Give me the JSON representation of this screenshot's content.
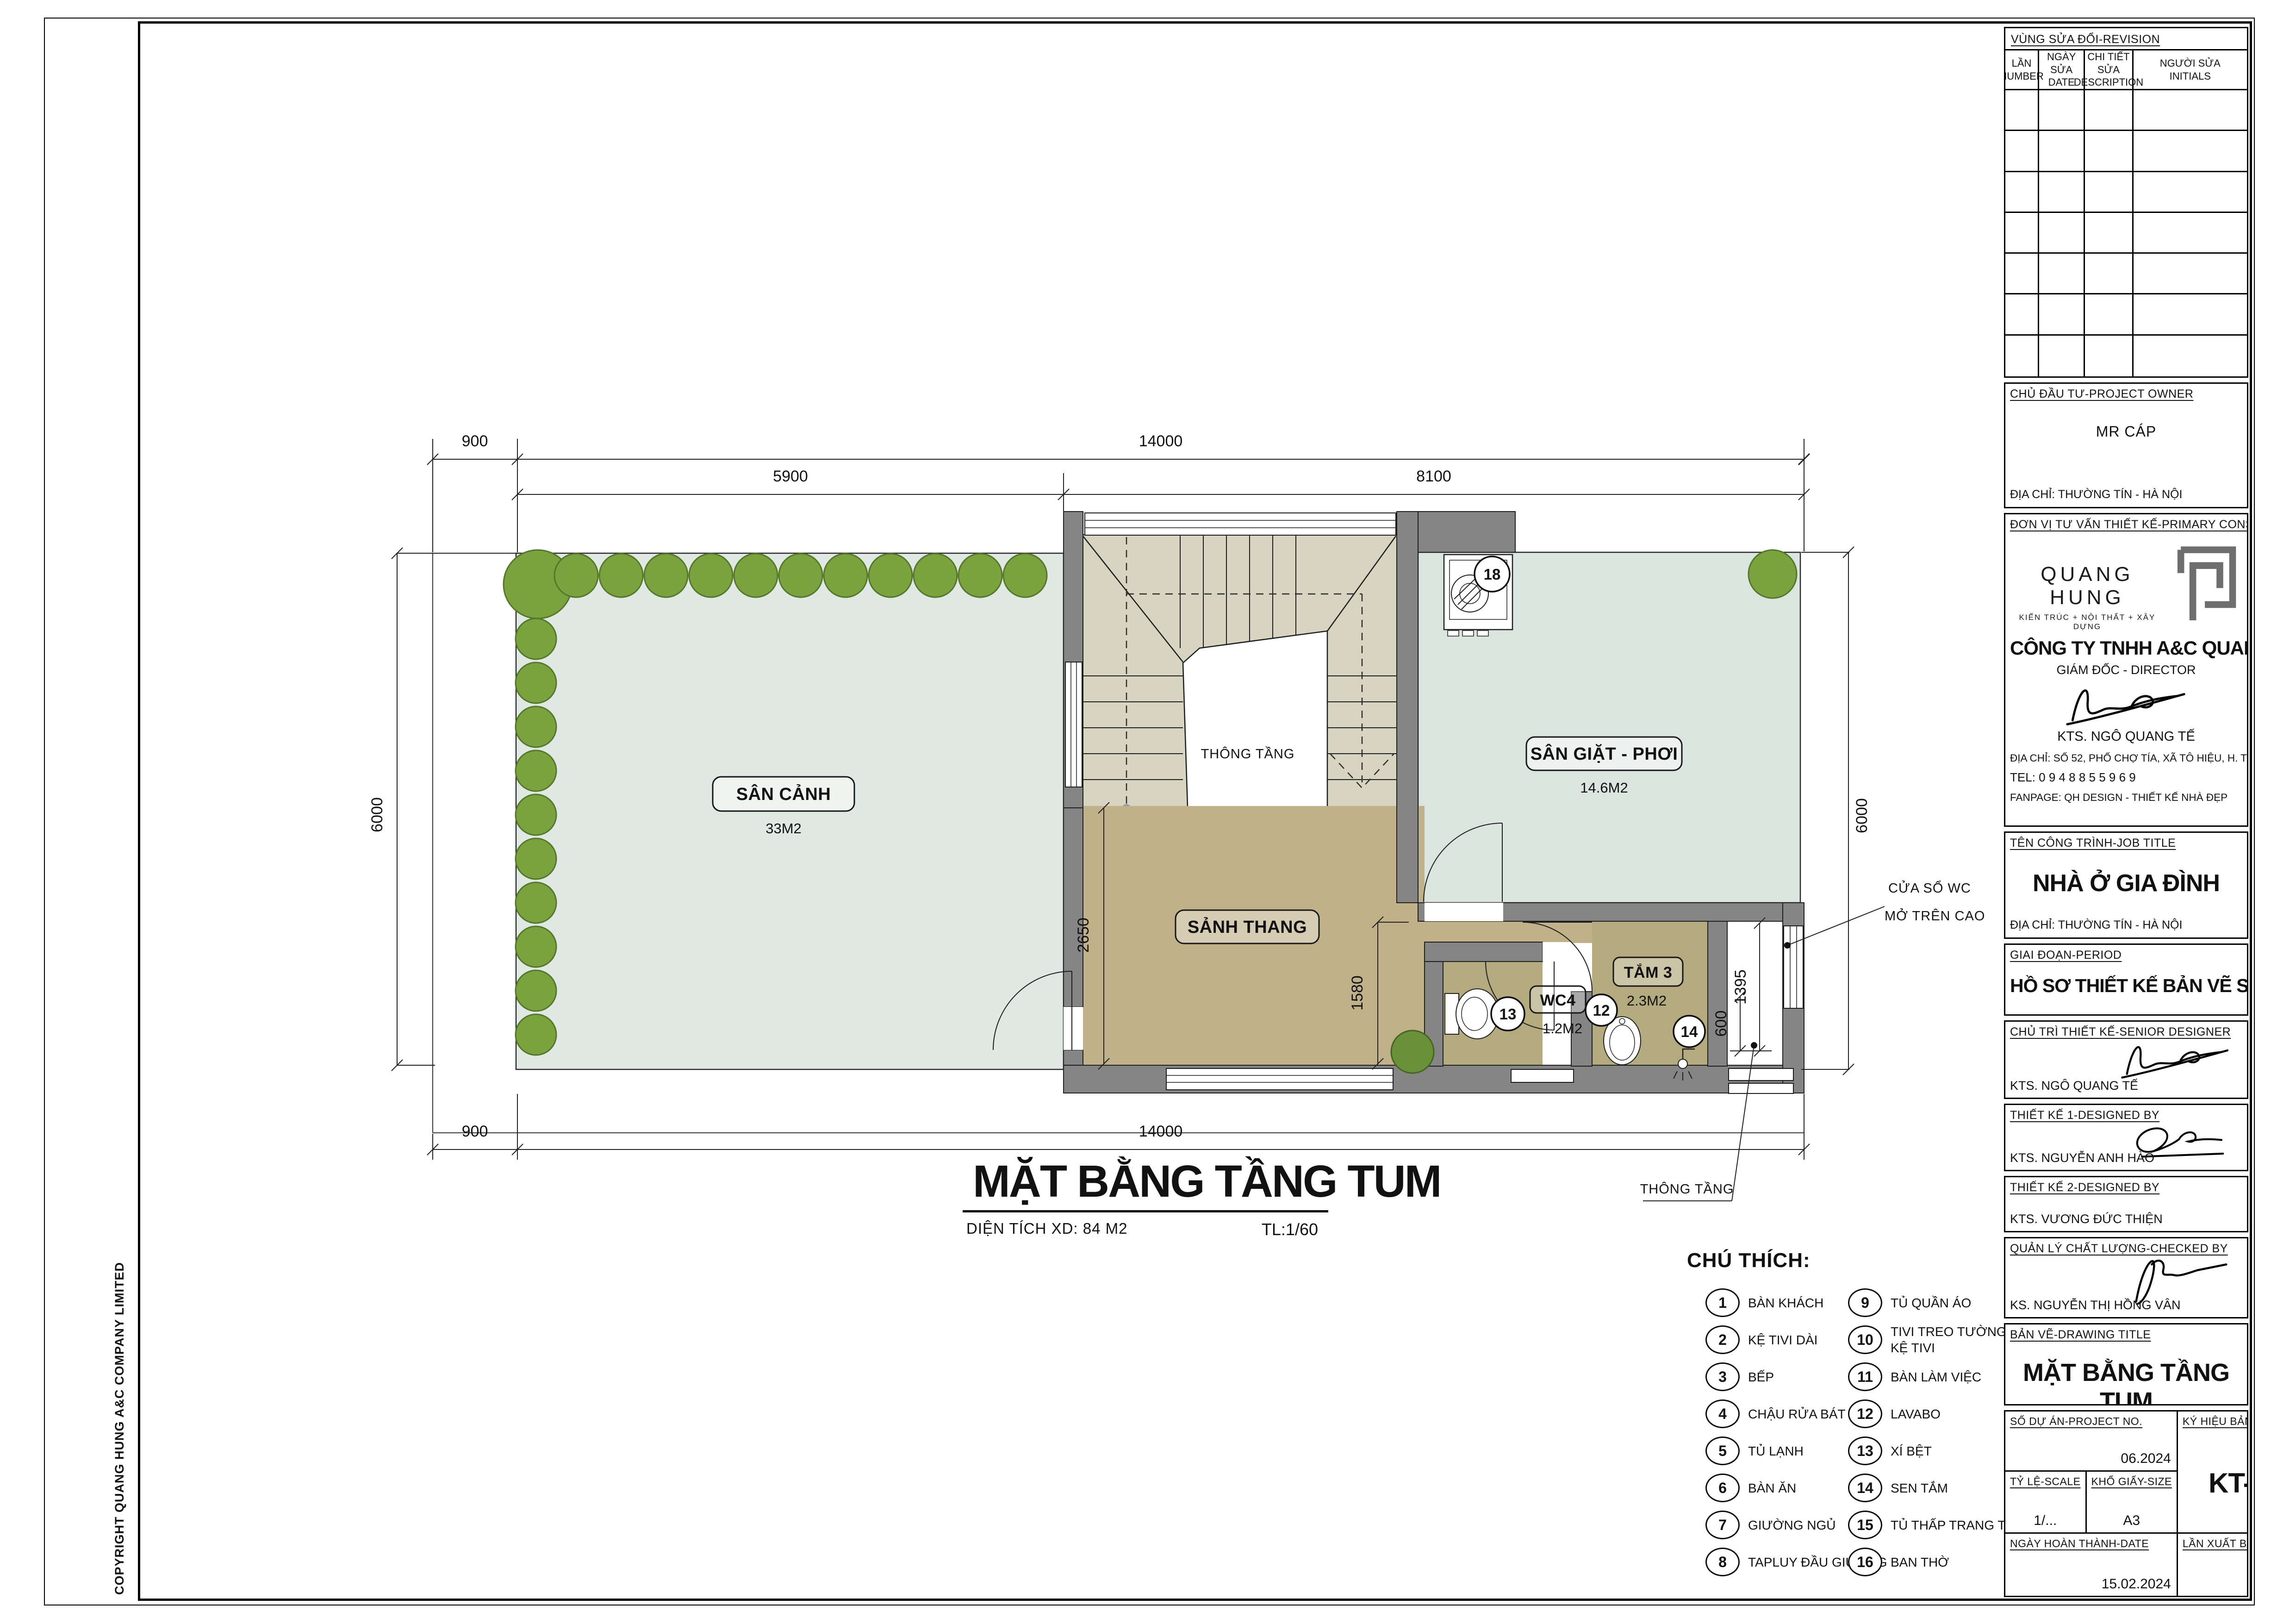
{
  "sheet": {
    "copyright": "COPYRIGHT QUANG HUNG A&C COMPANY LIMITED"
  },
  "colors": {
    "wall": "#858585",
    "garden_floor": "#dfe8e2",
    "laundry_floor": "#dbe5e0",
    "stair_floor": "#d8d4c2",
    "hall_floor": "#c0b18b",
    "bath_floor": "#b4aa80",
    "tree": "#7aa23e",
    "line": "#1c1c1c"
  },
  "plan": {
    "caption": {
      "title": "MẶT BẰNG TẦNG TUM",
      "area": "DIỆN TÍCH XD: 84 M2",
      "scale": "TL:1/60"
    },
    "rooms": {
      "san_canh": {
        "name": "SÂN CẢNH",
        "area": "33M2"
      },
      "san_giat": {
        "name": "SÂN GIẶT - PHƠI",
        "area": "14.6M2"
      },
      "sanh_thang": {
        "name": "SẢNH THANG"
      },
      "tam3": {
        "name": "TẮM 3",
        "area": "2.3M2"
      },
      "wc4": {
        "name": "WC4",
        "area": "1.2M2"
      },
      "stair_void": "THÔNG TẦNG"
    },
    "markers": {
      "washer": "18",
      "lavabo": "12",
      "toilet": "13",
      "shower": "14"
    },
    "dims": {
      "offset": "900",
      "total": "14000",
      "left_span": "5900",
      "right_span": "8100",
      "height": "6000",
      "hall": "2650",
      "bath": "1580",
      "shaft_h": "1395",
      "shaft_w": "600"
    },
    "notes": {
      "wc_window1": "CỬA SỔ WC",
      "wc_window2": "MỞ TRÊN CAO",
      "void": "THÔNG TẦNG"
    }
  },
  "legend": {
    "title": "CHÚ THÍCH:",
    "items": [
      {
        "num": "1",
        "label": "BÀN KHÁCH"
      },
      {
        "num": "2",
        "label": "KỆ TIVI DÀI"
      },
      {
        "num": "3",
        "label": "BẾP"
      },
      {
        "num": "4",
        "label": "CHẬU RỬA BÁT"
      },
      {
        "num": "5",
        "label": "TỦ LẠNH"
      },
      {
        "num": "6",
        "label": "BÀN ĂN"
      },
      {
        "num": "7",
        "label": "GIƯỜNG NGỦ"
      },
      {
        "num": "8",
        "label": "TAPLUY ĐẦU GIƯỜNG"
      },
      {
        "num": "9",
        "label": "TỦ QUẦN ÁO"
      },
      {
        "num": "10",
        "label": "TIVI TREO TƯỜNG",
        "label2": "KỆ TIVI"
      },
      {
        "num": "11",
        "label": "BÀN LÀM VIỆC"
      },
      {
        "num": "12",
        "label": "LAVABO"
      },
      {
        "num": "13",
        "label": "XÍ BỆT"
      },
      {
        "num": "14",
        "label": "SEN TẮM"
      },
      {
        "num": "15",
        "label": "TỦ THẤP TRANG TRÍ"
      },
      {
        "num": "16",
        "label": "BAN THỜ"
      }
    ]
  },
  "titleblock": {
    "revision": {
      "title": "VÙNG SỬA ĐỔI-REVISION",
      "cols": [
        {
          "l1": "LẦN",
          "l2": "NUMBER"
        },
        {
          "l1": "NGÀY SỬA",
          "l2": "DATE"
        },
        {
          "l1": "CHI TIẾT SỬA",
          "l2": "DESCRIPTION"
        },
        {
          "l1": "NGƯỜI SỬA",
          "l2": "INITIALS"
        }
      ]
    },
    "owner": {
      "heading": "CHỦ ĐẦU TƯ-PROJECT OWNER",
      "name": "MR CÁP",
      "address": "ĐỊA CHỈ: THƯỜNG TÍN - HÀ NỘI"
    },
    "consultant": {
      "heading": "ĐƠN VỊ TƯ VẤN THIẾT KẾ-PRIMARY CONSULTANT",
      "logo_name": "QUANG HUNG",
      "logo_tagline": "KIẾN TRÚC + NỘI THẤT + XÂY DỰNG",
      "company": "CÔNG TY TNHH A&C QUANG HƯNG",
      "role": "GIÁM ĐỐC - DIRECTOR",
      "director": "KTS. NGÔ QUANG TẾ",
      "address": "ĐỊA CHỈ: SỐ 52, PHỐ CHỢ TÍA, XÃ TÔ HIỆU, H. THƯỜNG TÍN, HÀ NỘI",
      "tel": "TEL: 0 9 4 8 8 5 5 9 6 9",
      "fanpage": "FANPAGE: QH DESIGN - THIẾT KẾ NHÀ ĐẸP"
    },
    "job": {
      "heading": "TÊN CÔNG TRÌNH-JOB TITLE",
      "name": "NHÀ Ở GIA ĐÌNH",
      "address": "ĐỊA CHỈ: THƯỜNG TÍN - HÀ NỘI"
    },
    "period": {
      "heading": "GIAI ĐOẠN-PERIOD",
      "name": "HỒ SƠ THIẾT KẾ BẢN VẼ SƠ BỘ"
    },
    "senior": {
      "heading": "CHỦ TRÌ THIẾT KẾ-SENIOR DESIGNER",
      "name": "KTS. NGÔ QUANG TẾ"
    },
    "design1": {
      "heading": "THIẾT KẾ 1-DESIGNED BY",
      "name": "KTS. NGUYỄN ANH HÀO"
    },
    "design2": {
      "heading": "THIẾT KẾ 2-DESIGNED BY",
      "name": "KTS. VƯƠNG ĐỨC THIỆN"
    },
    "checked": {
      "heading": "QUẢN LÝ CHẤT LƯỢNG-CHECKED BY",
      "name": "KS. NGUYỄN THỊ HỒNG VÂN"
    },
    "drawing": {
      "heading": "BẢN VẼ-DRAWING TITLE",
      "title": "MẶT BẰNG TẦNG TUM"
    },
    "meta": {
      "project_label": "SỐ DỰ ÁN-PROJECT NO.",
      "project_value": "06.2024",
      "no_label": "KÝ HIỆU BẢN VẼ-DRAWING NO.",
      "no_value": "KT-A0.04",
      "scale_label": "TỶ LỆ-SCALE",
      "scale_value": "1/...",
      "size_label": "KHỔ GIẤY-SIZE",
      "size_value": "A3",
      "date_label": "NGÀY HOÀN THÀNH-DATE",
      "date_value": "15.02.2024",
      "rev_label": "LẦN XUẤT BẢN-REVISION",
      "rev_value": "R01"
    }
  }
}
